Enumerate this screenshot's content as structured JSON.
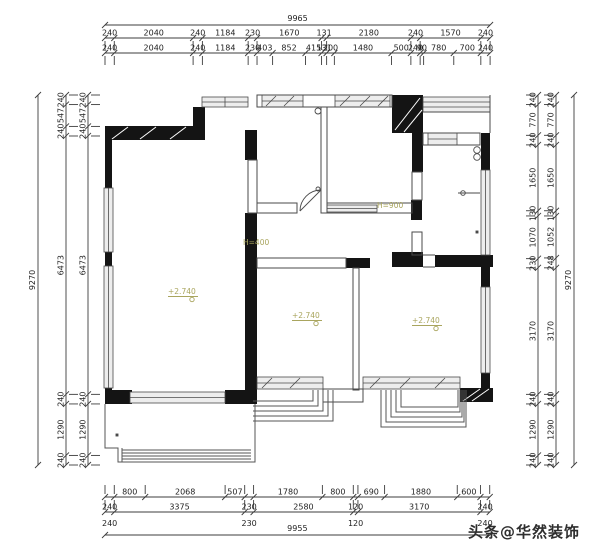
{
  "annotations": {
    "h_label_window": "H=900",
    "h_label_corridor": "H=400",
    "level_marker_living": "+2.740",
    "level_marker_bed_mid": "+2.740",
    "level_marker_bed_right": "+2.740"
  },
  "watermark": {
    "text": "头条@华然装饰"
  },
  "colors": {
    "wall": "#141414",
    "thin_line": "#4a4a4a",
    "dim_line": "#3c3c3c",
    "dim_text": "#1f1f1f",
    "annotation": "#a9a55e",
    "window_fill": "#ededed",
    "watermark": "#2e2e2e",
    "background": "#ffffff"
  },
  "dimensions": {
    "top": {
      "overall": {
        "total": 9965,
        "label": "9965"
      },
      "rows": [
        {
          "name": "top-row-1",
          "segments": [
            {
              "value": 240,
              "label": "240"
            },
            {
              "value": 2040,
              "label": "2040"
            },
            {
              "value": 240,
              "label": "240"
            },
            {
              "value": 1184,
              "label": "1184"
            },
            {
              "value": 230,
              "label": "230"
            },
            {
              "value": 1670,
              "label": "1670"
            },
            {
              "value": 131,
              "label": "131"
            },
            {
              "value": 2180,
              "label": "2180"
            },
            {
              "value": 240,
              "label": "240"
            },
            {
              "value": 1570,
              "label": "1570"
            },
            {
              "value": 240,
              "label": "240"
            }
          ]
        },
        {
          "name": "top-row-2",
          "segments": [
            {
              "value": 240,
              "label": "240"
            },
            {
              "value": 2040,
              "label": "2040"
            },
            {
              "value": 240,
              "label": "240"
            },
            {
              "value": 1184,
              "label": "1184"
            },
            {
              "value": 230,
              "label": "230"
            },
            {
              "value": 403,
              "label": "403"
            },
            {
              "value": 852,
              "label": "852"
            },
            {
              "value": 415,
              "label": "415"
            },
            {
              "value": 131,
              "label": "131"
            },
            {
              "value": 200,
              "label": "200"
            },
            {
              "value": 1480,
              "label": "1480"
            },
            {
              "value": 500,
              "label": "500"
            },
            {
              "value": 240,
              "label": "240"
            },
            {
              "value": 90,
              "label": "90"
            },
            {
              "value": 780,
              "label": "780"
            },
            {
              "value": 700,
              "label": "700"
            },
            {
              "value": 240,
              "label": "240"
            }
          ]
        }
      ]
    },
    "bottom": {
      "overall": {
        "total": 9955,
        "label": "9955",
        "extra_labels": [
          {
            "label": "240",
            "position_mm": 120
          },
          {
            "label": "230",
            "position_mm": 3730
          },
          {
            "label": "120",
            "position_mm": 6485
          },
          {
            "label": "240",
            "position_mm": 9835
          }
        ]
      },
      "rows": [
        {
          "name": "bottom-row-1",
          "segments": [
            {
              "value": 240,
              "label": ""
            },
            {
              "value": 800,
              "label": "800"
            },
            {
              "value": 2068,
              "label": "2068"
            },
            {
              "value": 507,
              "label": "507"
            },
            {
              "value": 230,
              "label": ""
            },
            {
              "value": 1780,
              "label": "1780"
            },
            {
              "value": 800,
              "label": "800"
            },
            {
              "value": 120,
              "label": ""
            },
            {
              "value": 690,
              "label": "690"
            },
            {
              "value": 1880,
              "label": "1880"
            },
            {
              "value": 600,
              "label": "600"
            },
            {
              "value": 240,
              "label": ""
            }
          ]
        },
        {
          "name": "bottom-row-2",
          "segments": [
            {
              "value": 240,
              "label": "240"
            },
            {
              "value": 3375,
              "label": "3375"
            },
            {
              "value": 230,
              "label": "230"
            },
            {
              "value": 2580,
              "label": "2580"
            },
            {
              "value": 120,
              "label": "120"
            },
            {
              "value": 3170,
              "label": "3170"
            },
            {
              "value": 240,
              "label": "240"
            }
          ]
        }
      ]
    },
    "left": {
      "overall": {
        "total": 9270,
        "label": "9270"
      },
      "rows": [
        {
          "name": "left-row-1",
          "segments": [
            {
              "value": 240,
              "label": "240"
            },
            {
              "value": 547,
              "label": "547"
            },
            {
              "value": 240,
              "label": "240"
            },
            {
              "value": 6473,
              "label": "6473"
            },
            {
              "value": 240,
              "label": "240"
            },
            {
              "value": 1290,
              "label": "1290"
            },
            {
              "value": 240,
              "label": "240"
            }
          ]
        },
        {
          "name": "left-row-2",
          "segments": [
            {
              "value": 240,
              "label": "240"
            },
            {
              "value": 547,
              "label": "547"
            },
            {
              "value": 240,
              "label": "240"
            },
            {
              "value": 6473,
              "label": "6473"
            },
            {
              "value": 240,
              "label": "240"
            },
            {
              "value": 1290,
              "label": "1290"
            },
            {
              "value": 240,
              "label": "240"
            }
          ]
        }
      ]
    },
    "right": {
      "overall": {
        "total": 9270,
        "label": "9270"
      },
      "rows": [
        {
          "name": "right-row-1",
          "segments": [
            {
              "value": 240,
              "label": "240"
            },
            {
              "value": 770,
              "label": "770"
            },
            {
              "value": 240,
              "label": "240"
            },
            {
              "value": 1650,
              "label": "1650"
            },
            {
              "value": 130,
              "label": "130"
            },
            {
              "value": 1070,
              "label": "1070"
            },
            {
              "value": 230,
              "label": "230"
            },
            {
              "value": 3170,
              "label": "3170"
            },
            {
              "value": 240,
              "label": "240"
            },
            {
              "value": 1290,
              "label": "1290"
            },
            {
              "value": 240,
              "label": "240"
            }
          ]
        },
        {
          "name": "right-row-2",
          "segments": [
            {
              "value": 240,
              "label": "240"
            },
            {
              "value": 770,
              "label": "770"
            },
            {
              "value": 240,
              "label": "240"
            },
            {
              "value": 1650,
              "label": "1650"
            },
            {
              "value": 130,
              "label": "130"
            },
            {
              "value": 1052,
              "label": "1052"
            },
            {
              "value": 248,
              "label": "248"
            },
            {
              "value": 3170,
              "label": "3170"
            },
            {
              "value": 240,
              "label": "240"
            },
            {
              "value": 1290,
              "label": "1290"
            },
            {
              "value": 240,
              "label": "240"
            }
          ]
        }
      ]
    }
  }
}
